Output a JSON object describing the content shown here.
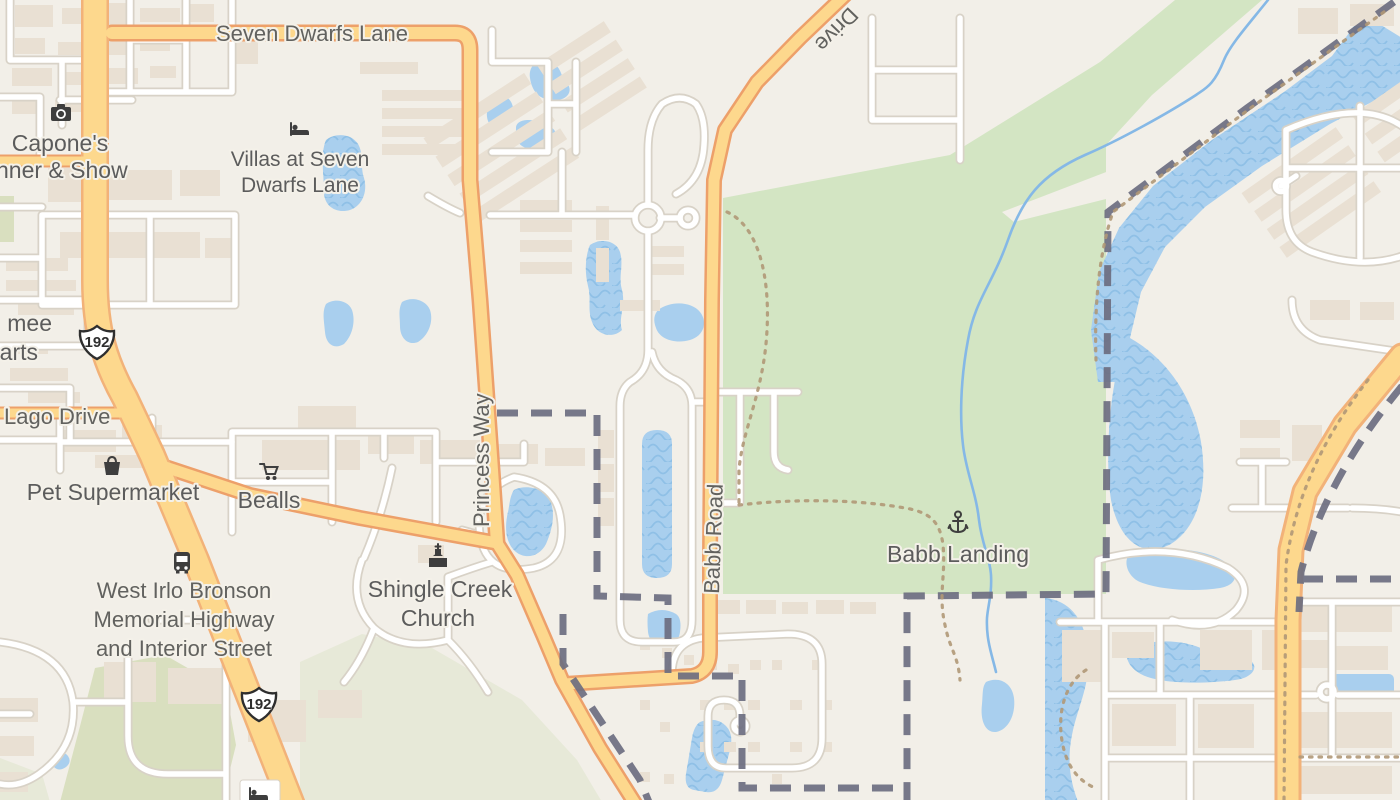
{
  "map": {
    "type": "street-map",
    "labels": {
      "seven_dwarfs_lane": "Seven Dwarfs Lane",
      "drive_partial": "Drive",
      "capones_1": "Capone's",
      "capones_2": "nner & Show",
      "villas_1": "Villas at Seven",
      "villas_2": "Dwarfs Lane",
      "clipped_poi_1": "mee",
      "clipped_poi_2": "arts",
      "lago_drive": "Lago Drive",
      "pet_supermarket": "Pet Supermarket",
      "bealls": "Bealls",
      "west_irlo_1": "West Irlo Bronson",
      "west_irlo_2": "Memorial Highway",
      "west_irlo_3": "and Interior Street",
      "princess_way": "Princess Way",
      "shingle_creek_1": "Shingle Creek",
      "shingle_creek_2": "Church",
      "babb_road": "Babb Road",
      "babb_landing": "Babb Landing",
      "route_192": "192"
    },
    "icons": [
      "camera-icon",
      "bed-icon",
      "shopping-bag-icon",
      "shopping-cart-icon",
      "bus-icon",
      "church-icon",
      "anchor-icon",
      "us-route-shield"
    ],
    "colors": {
      "background": "#f2efe8",
      "park": "#d3e5c3",
      "park_dark": "#d9dfbf",
      "pale_green": "#e7e9d8",
      "water": "#a9cfee",
      "water_wave": "#8fc0e6",
      "creek": "#85b8e6",
      "building": "#e9e0d3",
      "road_fill": "#fdd88d",
      "road_casing": "#eda06a",
      "road_casing_major": "#f2b279",
      "local_road": "#ffffff",
      "local_casing": "#d8d2c7",
      "boundary": "#6c6e80",
      "trail": "#b09877",
      "label": "#5c5c5c",
      "halo": "#f4f1e9",
      "icon": "#3e3e3e"
    }
  }
}
